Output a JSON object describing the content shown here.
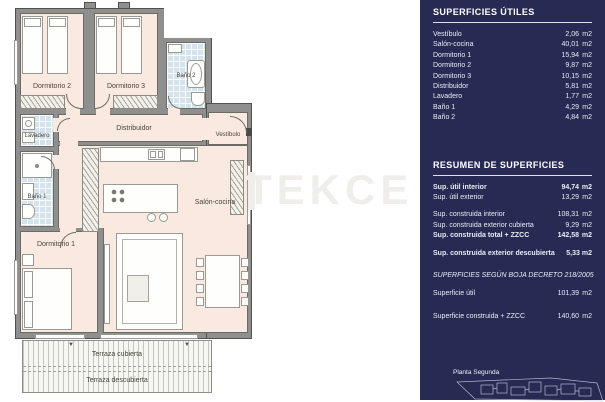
{
  "watermark": "TEKCE",
  "plan": {
    "rooms": {
      "dormitorio2": "Dormitorio 2",
      "dormitorio3": "Dormitorio 3",
      "bano2": "Baño 2",
      "distribuidor": "Distribuidor",
      "vestibulo": "Vestíbulo",
      "lavadero": "Lavadero",
      "bano1": "Baño 1",
      "dormitorio1": "Dormitorio 1",
      "salon": "Salón-cocina",
      "terraza_cubierta": "Terraza cubierta",
      "terraza_descubierta": "Terraza descubierta"
    }
  },
  "panel": {
    "accent_bg": "#272b53",
    "utiles": {
      "title": "SUPERFICIES ÚTILES",
      "rows": [
        {
          "label": "Vestíbulo",
          "value": "2,06",
          "unit": "m2"
        },
        {
          "label": "Salón-cocina",
          "value": "40,01",
          "unit": "m2"
        },
        {
          "label": "Dormitorio 1",
          "value": "15,94",
          "unit": "m2"
        },
        {
          "label": "Dormitorio 2",
          "value": "9,87",
          "unit": "m2"
        },
        {
          "label": "Dormitorio 3",
          "value": "10,15",
          "unit": "m2"
        },
        {
          "label": "Distribuidor",
          "value": "5,81",
          "unit": "m2"
        },
        {
          "label": "Lavadero",
          "value": "1,77",
          "unit": "m2"
        },
        {
          "label": "Baño 1",
          "value": "4,29",
          "unit": "m2"
        },
        {
          "label": "Baño 2",
          "value": "4,84",
          "unit": "m2"
        }
      ]
    },
    "resumen": {
      "title": "RESUMEN DE SUPERFICIES",
      "rows": [
        {
          "label": "Sup. útil interior",
          "value": "94,74",
          "unit": "m2"
        },
        {
          "label": "Sup. útil exterior",
          "value": "13,29",
          "unit": "m2"
        },
        {
          "label": "Sup. construida interior",
          "value": "108,31",
          "unit": "m2"
        },
        {
          "label": "Sup. construida exterior cubierta",
          "value": "9,29",
          "unit": "m2"
        },
        {
          "label": "Sup. construida total + ZZCC",
          "value": "142,58",
          "unit": "m2"
        },
        {
          "label": "Sup. construida exterior descubierta",
          "value": "5,33",
          "unit": "m2"
        }
      ]
    },
    "boja": {
      "title": "SUPERFICIES SEGÚN BOJA DECRETO 218/2005",
      "rows": [
        {
          "label": "Superficie útil",
          "value": "101,39",
          "unit": "m2"
        },
        {
          "label": "Superficie construida + ZZCC",
          "value": "140,60",
          "unit": "m2"
        }
      ]
    },
    "footer": {
      "label": "Planta Segunda"
    }
  }
}
